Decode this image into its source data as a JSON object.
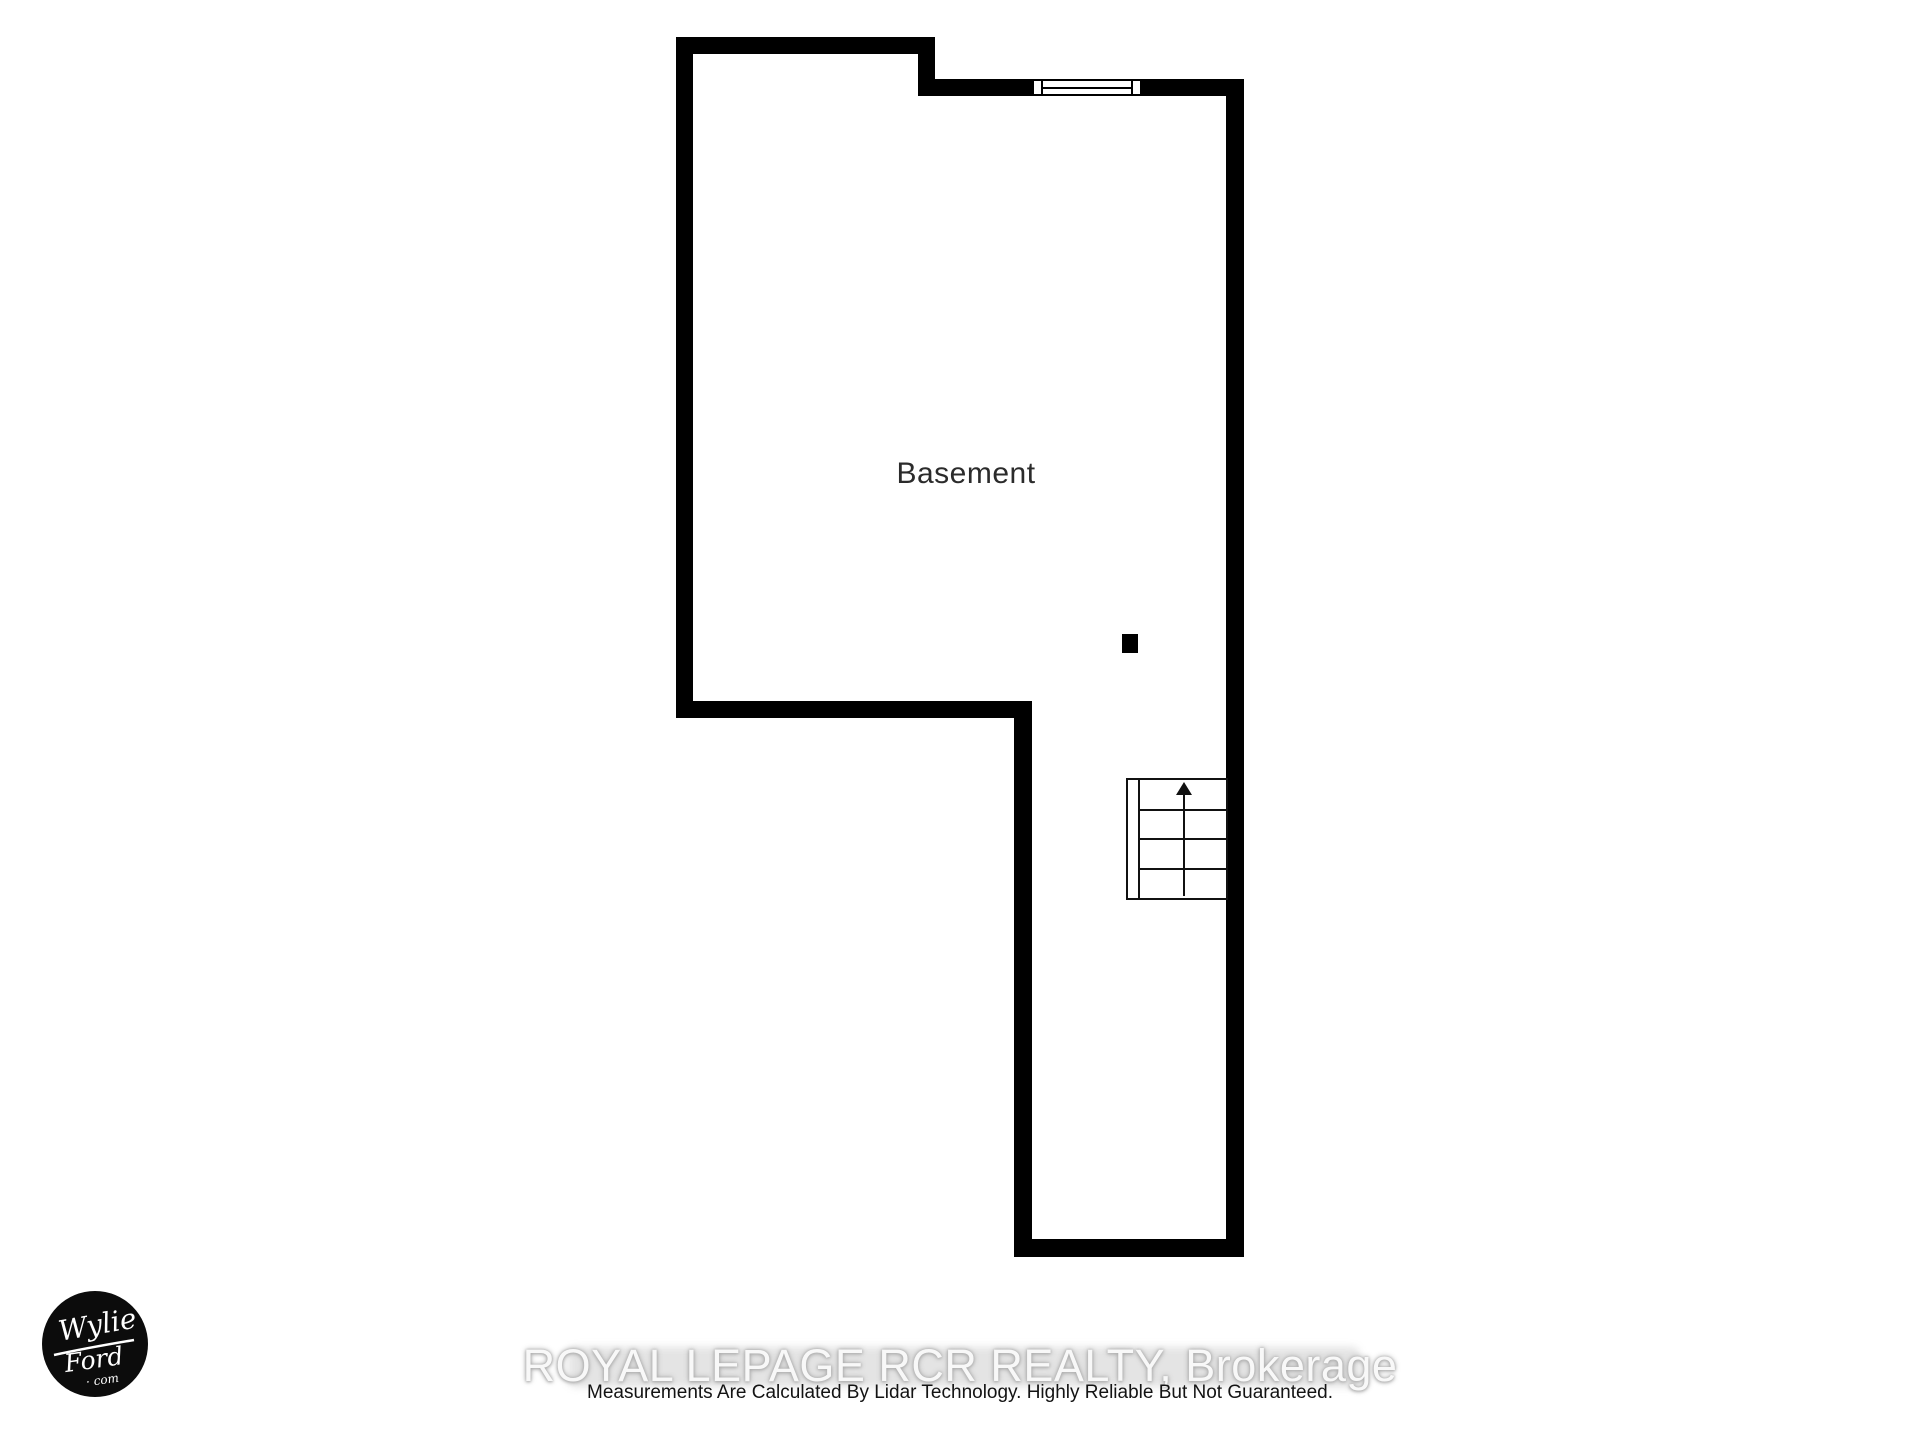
{
  "page": {
    "background_color": "#ffffff",
    "wall_color": "#000000"
  },
  "floor_plan": {
    "room_label": "Basement",
    "label_color": "#2b2b2b",
    "features": {
      "window": "window-symbol",
      "stairs": "staircase-going-up",
      "post": "support-post-marker"
    }
  },
  "stairs": {
    "direction": "up",
    "arrow_icon": "▲",
    "tread_count": 4
  },
  "logo": {
    "line1": "Wylie",
    "line2": "Ford",
    "line3": "· com",
    "circle_color": "#0c0c0c",
    "text_color": "#ffffff"
  },
  "watermark": {
    "text": "ROYAL LEPAGE RCR REALTY, Brokerage",
    "color": "#f8f8f8"
  },
  "disclaimer": {
    "text": "Measurements Are Calculated By Lidar Technology. Highly Reliable But Not Guaranteed.",
    "color": "#131313"
  }
}
